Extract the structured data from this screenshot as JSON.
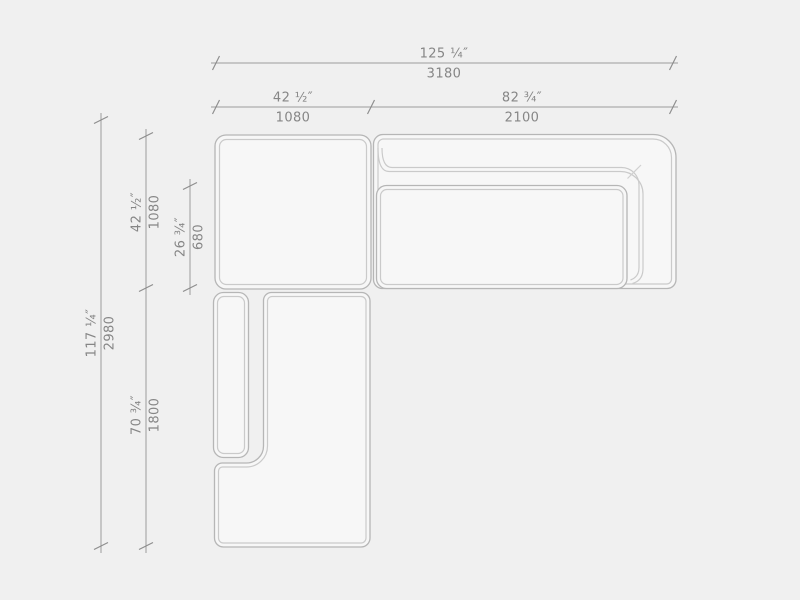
{
  "palette": {
    "background": "#f0f0f0",
    "furniture_fill": "#f7f7f7",
    "outline_outer": "#b6b6b6",
    "outline_inner": "#cacaca",
    "dimension_line": "#9c9c9c",
    "text": "#868686"
  },
  "dimensions": {
    "top_total": {
      "inches": "125 ¼″",
      "mm": "3180"
    },
    "top_corner": {
      "inches": "42 ½″",
      "mm": "1080"
    },
    "top_sofa": {
      "inches": "82 ¾″",
      "mm": "2100"
    },
    "left_total": {
      "inches": "117 ¼″",
      "mm": "2980"
    },
    "left_corner": {
      "inches": "42 ½″",
      "mm": "1080"
    },
    "left_seat_depth": {
      "inches": "26 ¾″",
      "mm": "680"
    },
    "left_chaise": {
      "inches": "70 ¾″",
      "mm": "1800"
    }
  }
}
